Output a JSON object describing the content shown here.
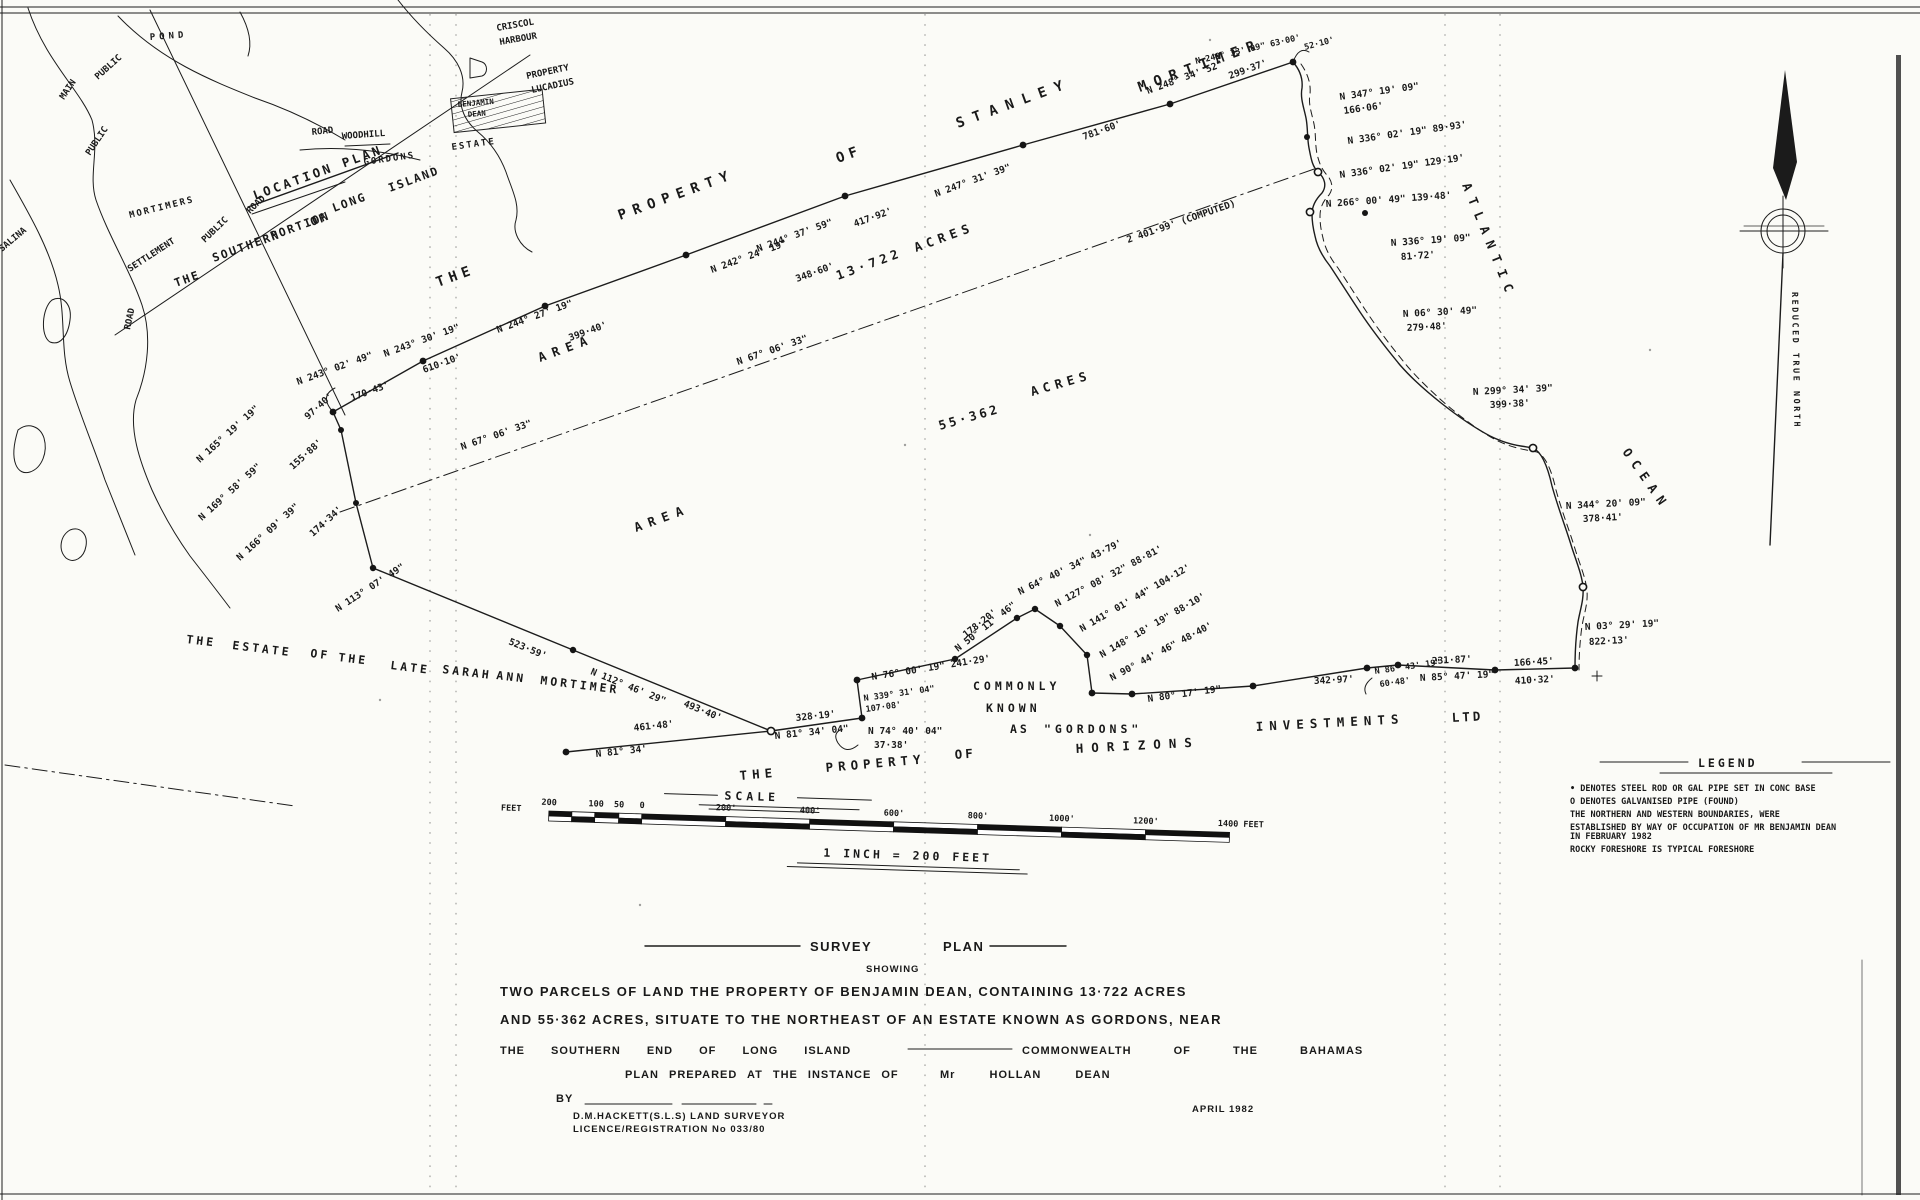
{
  "location_plan": {
    "title": "LOCATION PLAN",
    "subtitle": [
      "THE",
      "SOUTHERN",
      "PORTION",
      "OF",
      "LONG",
      "ISLAND"
    ],
    "labels": {
      "pond": "POND",
      "public_upper": "PUBLIC",
      "main": "MAIN",
      "public_lower": "PUBLIC",
      "salina": "SALINA",
      "road_left": "ROAD",
      "mortimers": "MORTIMERS",
      "settlement": "SETTLEMENT",
      "public_road": "PUBLIC",
      "road_mid": "ROAD",
      "road_woodhill": "ROAD",
      "woodhill": "WOODHILL",
      "gordons": "GORDONS",
      "estate": "ESTATE",
      "harbour1": "CRISCOL",
      "harbour2": "HARBOUR",
      "property": "PROPERTY",
      "property2": "LUCADIUS",
      "benjamin": "BENJAMIN",
      "dean": "DEAN"
    }
  },
  "north_arrow": {
    "label": "REDUCED TRUE NORTH"
  },
  "owner_top": [
    "THE",
    "PROPERTY",
    "OF",
    "STANLEY",
    "MORTIMER"
  ],
  "areas": {
    "a1_label": "AREA",
    "a1_value": "13·722",
    "a1_unit": "ACRES",
    "a2_label": "AREA",
    "a2_value": "55·362",
    "a2_unit": "ACRES"
  },
  "estate_words": [
    "THE",
    "ESTATE",
    "OF",
    "THE",
    "LATE",
    "SARAH",
    "ANN",
    "MORTIMER"
  ],
  "gordons_words": [
    "COMMONLY",
    "KNOWN",
    "AS",
    "\"GORDONS\""
  ],
  "south_owner": {
    "the": "THE",
    "property": "PROPERTY",
    "of": "OF",
    "horizons": "HORIZONS",
    "investments": "INVESTMENTS",
    "ltd": "LTD"
  },
  "ocean": {
    "w1": "ATLANTIC",
    "w2": "OCEAN"
  },
  "bearings": [
    "N 243° 02' 49\"",
    "170·43'",
    "N 243° 30' 19\"",
    "610·10'",
    "N 244° 27' 19\"",
    "399·40'",
    "N 242° 24' 19\"",
    "348·60'",
    "N 244° 37' 59\"",
    "417·92'",
    "N 247° 31' 39\"",
    "781·60'",
    "N 248° 34' 52\"",
    "299·37'",
    "N 249° 33' 09\"  63·00'",
    "N 347° 19' 09\"",
    "166·06'",
    "N 336° 02' 19\"  89·93'",
    "N 336° 02' 19\"  129·19'",
    "N 266° 00' 49\"  139·48'",
    "N 336° 19' 09\"",
    "81·72'",
    "2 401·99' (COMPUTED)",
    "N 06° 30' 49\"",
    "279·48'",
    "N 299° 34' 39\"",
    "399·38'",
    "N 344° 20' 09\"",
    "378·41'",
    "N 03° 29' 19\"",
    "822·13'",
    "N 67° 06' 33\"",
    "N 165° 19' 19\"",
    "97·40'",
    "155·88'",
    "N 169° 58' 59\"",
    "174·34'",
    "N 166° 09' 39\"",
    "N 113° 07' 49\"",
    "523·59'",
    "N 112° 46' 29\"",
    "493·40'",
    "461·48'",
    "N 81° 34'",
    "328·19'",
    "N 81° 34' 04\"",
    "N 74° 40' 04\"",
    "37·38'",
    "N 339° 31' 04\"",
    "107·08'",
    "N 76° 00' 19\"  241·29'",
    "N 50° 11' 46\"",
    "178·20'",
    "N 64° 40' 34\"  43·79'",
    "N 127° 08' 32\"  88·81'",
    "N 141° 01' 44\"  104·12'",
    "N 148° 18' 19\"  88·10'",
    "N 90° 44' 46\"  48·40'",
    "N 80° 17' 19\"",
    "342·97'",
    "N 86° 43' 19\"",
    "60·48'",
    "231·87'",
    "N 85° 47' 19\"",
    "166·45'",
    "410·32'",
    "52·10'"
  ],
  "scale_bar": {
    "title": "SCALE",
    "feet_prefix": "FEET",
    "left_ticks": [
      "200",
      "100",
      "50",
      "0"
    ],
    "main_ticks": [
      "200'",
      "400'",
      "600'",
      "800'",
      "1000'",
      "1200'"
    ],
    "end_tick": "1400 FEET",
    "equation": "1 INCH  =  200 FEET"
  },
  "legend": {
    "title": "LEGEND",
    "lines": [
      "• DENOTES STEEL ROD OR GAL PIPE SET IN CONC BASE",
      "O DENOTES  GALVANISED  PIPE (FOUND)",
      "THE NORTHERN  AND  WESTERN  BOUNDARIES, WERE",
      "ESTABLISHED BY WAY OF OCCUPATION OF MR BENJAMIN DEAN",
      "IN FEBRUARY 1982",
      "ROCKY  FORESHORE  IS  TYPICAL  FORESHORE"
    ]
  },
  "title_block": {
    "heading1": "SURVEY",
    "heading2": "PLAN",
    "showing": "SHOWING",
    "line1": "TWO  PARCELS  OF  LAND  THE  PROPERTY  OF  BENJAMIN  DEAN, CONTAINING  13·722  ACRES",
    "line2": "AND  55·362 ACRES,  SITUATE  TO  THE  NORTHEAST  OF  AN  ESTATE  KNOWN  AS  GORDONS, NEAR",
    "line3a": "THE SOUTHERN END OF LONG ISLAND",
    "line3b": "COMMONWEALTH OF THE BAHAMAS",
    "line4a": "PLAN PREPARED AT THE INSTANCE OF",
    "line4b": "Mr HOLLAN DEAN",
    "by": "BY",
    "surveyor": "D.M.HACKETT(S.L.S)  LAND  SURVEYOR",
    "licence": "LICENCE/REGISTRATION  No  033/80",
    "date": "APRIL 1982"
  }
}
